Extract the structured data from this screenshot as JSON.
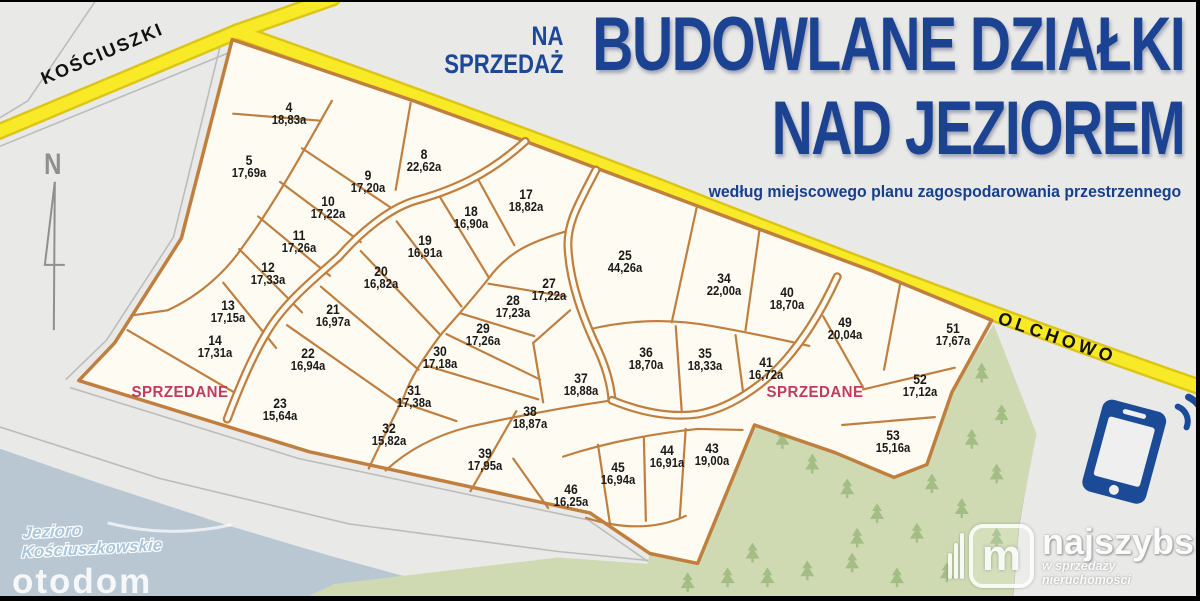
{
  "title": {
    "prefix_line1": "NA",
    "prefix_line2": "SPRZEDAŻ",
    "line1": "BUDOWLANE DZIAŁKI",
    "line2": "NAD JEZIOREM",
    "subtitle": "według miejscowego planu zagospodarowania przestrzennego"
  },
  "roads": {
    "west": "KOŚCIUSZKI",
    "east": "OLCHOWO"
  },
  "compass": "N",
  "lake_label": {
    "line1": "Jezioro",
    "line2": "Kościuszkowskie"
  },
  "watermark": "otodom",
  "logo": {
    "monogram": "m",
    "name": "najszybsi",
    "tagline": "w sprzedaży nieruchomości"
  },
  "sold_labels": [
    {
      "text": "SPRZEDANE",
      "x": 180,
      "y": 391
    },
    {
      "text": "SPRZEDANE",
      "x": 815,
      "y": 391
    }
  ],
  "plots": [
    {
      "no": "4",
      "area": "18,83a",
      "x": 289,
      "y": 112
    },
    {
      "no": "5",
      "area": "17,69a",
      "x": 249,
      "y": 165
    },
    {
      "no": "8",
      "area": "22,62a",
      "x": 424,
      "y": 159
    },
    {
      "no": "9",
      "area": "17,20a",
      "x": 368,
      "y": 180
    },
    {
      "no": "10",
      "area": "17,22a",
      "x": 328,
      "y": 206
    },
    {
      "no": "11",
      "area": "17,26a",
      "x": 299,
      "y": 240
    },
    {
      "no": "12",
      "area": "17,33a",
      "x": 268,
      "y": 272
    },
    {
      "no": "13",
      "area": "17,15a",
      "x": 228,
      "y": 310
    },
    {
      "no": "14",
      "area": "17,31a",
      "x": 215,
      "y": 345
    },
    {
      "no": "17",
      "area": "18,82a",
      "x": 526,
      "y": 199
    },
    {
      "no": "18",
      "area": "16,90a",
      "x": 471,
      "y": 216
    },
    {
      "no": "19",
      "area": "16,91a",
      "x": 425,
      "y": 245
    },
    {
      "no": "20",
      "area": "16,82a",
      "x": 381,
      "y": 276
    },
    {
      "no": "21",
      "area": "16,97a",
      "x": 333,
      "y": 314
    },
    {
      "no": "22",
      "area": "16,94a",
      "x": 308,
      "y": 358
    },
    {
      "no": "23",
      "area": "15,64a",
      "x": 280,
      "y": 408
    },
    {
      "no": "25",
      "area": "44,26a",
      "x": 625,
      "y": 260
    },
    {
      "no": "27",
      "area": "17,22a",
      "x": 549,
      "y": 288
    },
    {
      "no": "28",
      "area": "17,23a",
      "x": 513,
      "y": 305
    },
    {
      "no": "29",
      "area": "17,26a",
      "x": 483,
      "y": 333
    },
    {
      "no": "30",
      "area": "17,18a",
      "x": 440,
      "y": 356
    },
    {
      "no": "31",
      "area": "17,38a",
      "x": 414,
      "y": 395
    },
    {
      "no": "32",
      "area": "15,82a",
      "x": 389,
      "y": 433
    },
    {
      "no": "34",
      "area": "22,00a",
      "x": 724,
      "y": 283
    },
    {
      "no": "35",
      "area": "18,33a",
      "x": 705,
      "y": 358
    },
    {
      "no": "36",
      "area": "18,70a",
      "x": 646,
      "y": 357
    },
    {
      "no": "37",
      "area": "18,88a",
      "x": 581,
      "y": 383
    },
    {
      "no": "38",
      "area": "18,87a",
      "x": 530,
      "y": 416
    },
    {
      "no": "39",
      "area": "17,95a",
      "x": 485,
      "y": 458
    },
    {
      "no": "40",
      "area": "18,70a",
      "x": 787,
      "y": 297
    },
    {
      "no": "41",
      "area": "16,72a",
      "x": 766,
      "y": 367
    },
    {
      "no": "43",
      "area": "19,00a",
      "x": 712,
      "y": 453
    },
    {
      "no": "44",
      "area": "16,91a",
      "x": 667,
      "y": 455
    },
    {
      "no": "45",
      "area": "16,94a",
      "x": 618,
      "y": 472
    },
    {
      "no": "46",
      "area": "16,25a",
      "x": 571,
      "y": 494
    },
    {
      "no": "49",
      "area": "20,04a",
      "x": 845,
      "y": 327
    },
    {
      "no": "51",
      "area": "17,67a",
      "x": 953,
      "y": 333
    },
    {
      "no": "52",
      "area": "17,12a",
      "x": 920,
      "y": 384
    },
    {
      "no": "53",
      "area": "15,16a",
      "x": 893,
      "y": 440
    }
  ],
  "colors": {
    "background": "#e9e9e8",
    "plot_fill": "#fdfbf2",
    "plot_border": "#c07f3f",
    "road_yellow": "#f9ea28",
    "road_casing": "#dcc518",
    "lake": "#b9c7d2",
    "forest": "#cfdab2",
    "tree": "#a3bd85",
    "title_blue": "#1b4391",
    "sold_red": "#c23a60",
    "phone_blue": "#1b4a97"
  }
}
